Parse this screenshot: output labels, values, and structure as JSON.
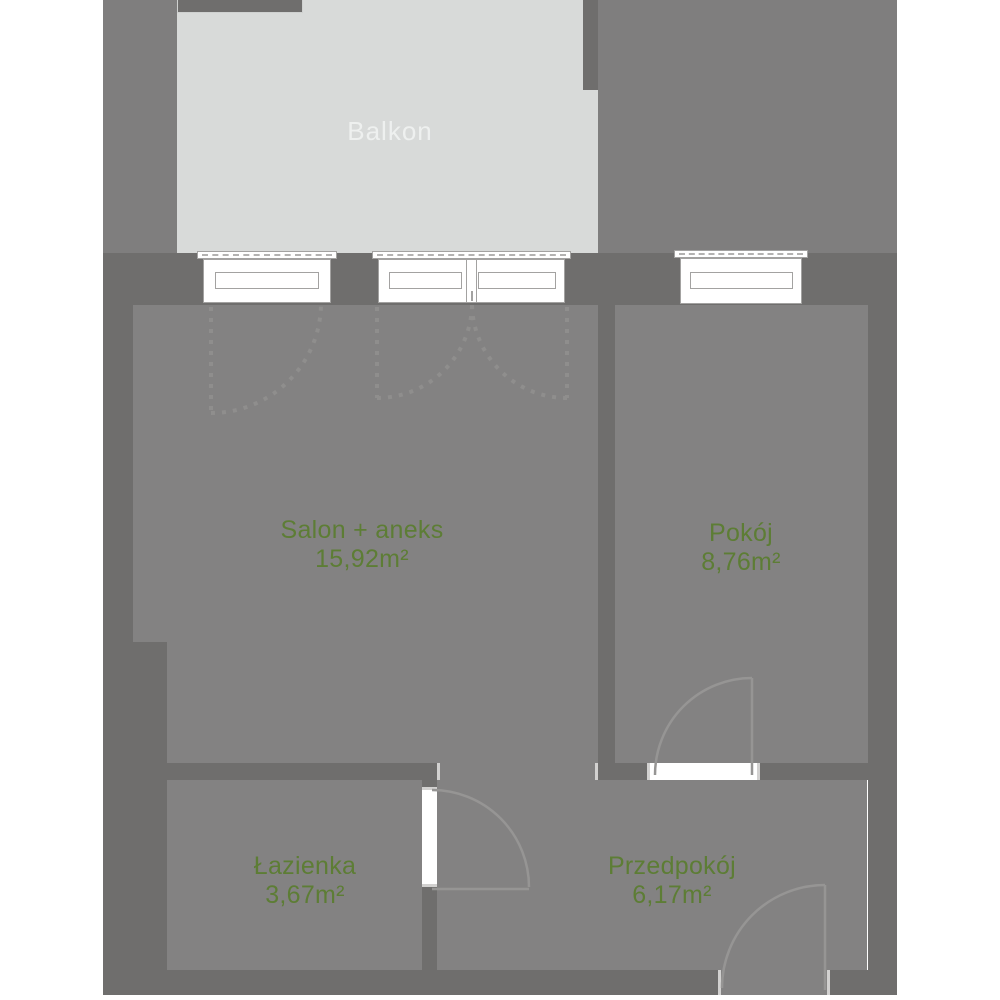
{
  "balcony": {
    "label": "Balkon"
  },
  "rooms": [
    {
      "id": "salon",
      "name": "Salon + aneks",
      "area": "15,92m²"
    },
    {
      "id": "pokoj",
      "name": "Pokój",
      "area": "8,76m²"
    },
    {
      "id": "lazienka",
      "name": "Łazienka",
      "area": "3,67m²"
    },
    {
      "id": "przedpokoj",
      "name": "Przedpokój",
      "area": "6,17m²"
    }
  ],
  "colors": {
    "wall": "#6f6e6d",
    "floor": "#838282",
    "building_mass": "#7f7e7e",
    "balcony": "#d8dad9",
    "label_green": "#5d7d35",
    "balcony_label": "#eef0ef"
  }
}
